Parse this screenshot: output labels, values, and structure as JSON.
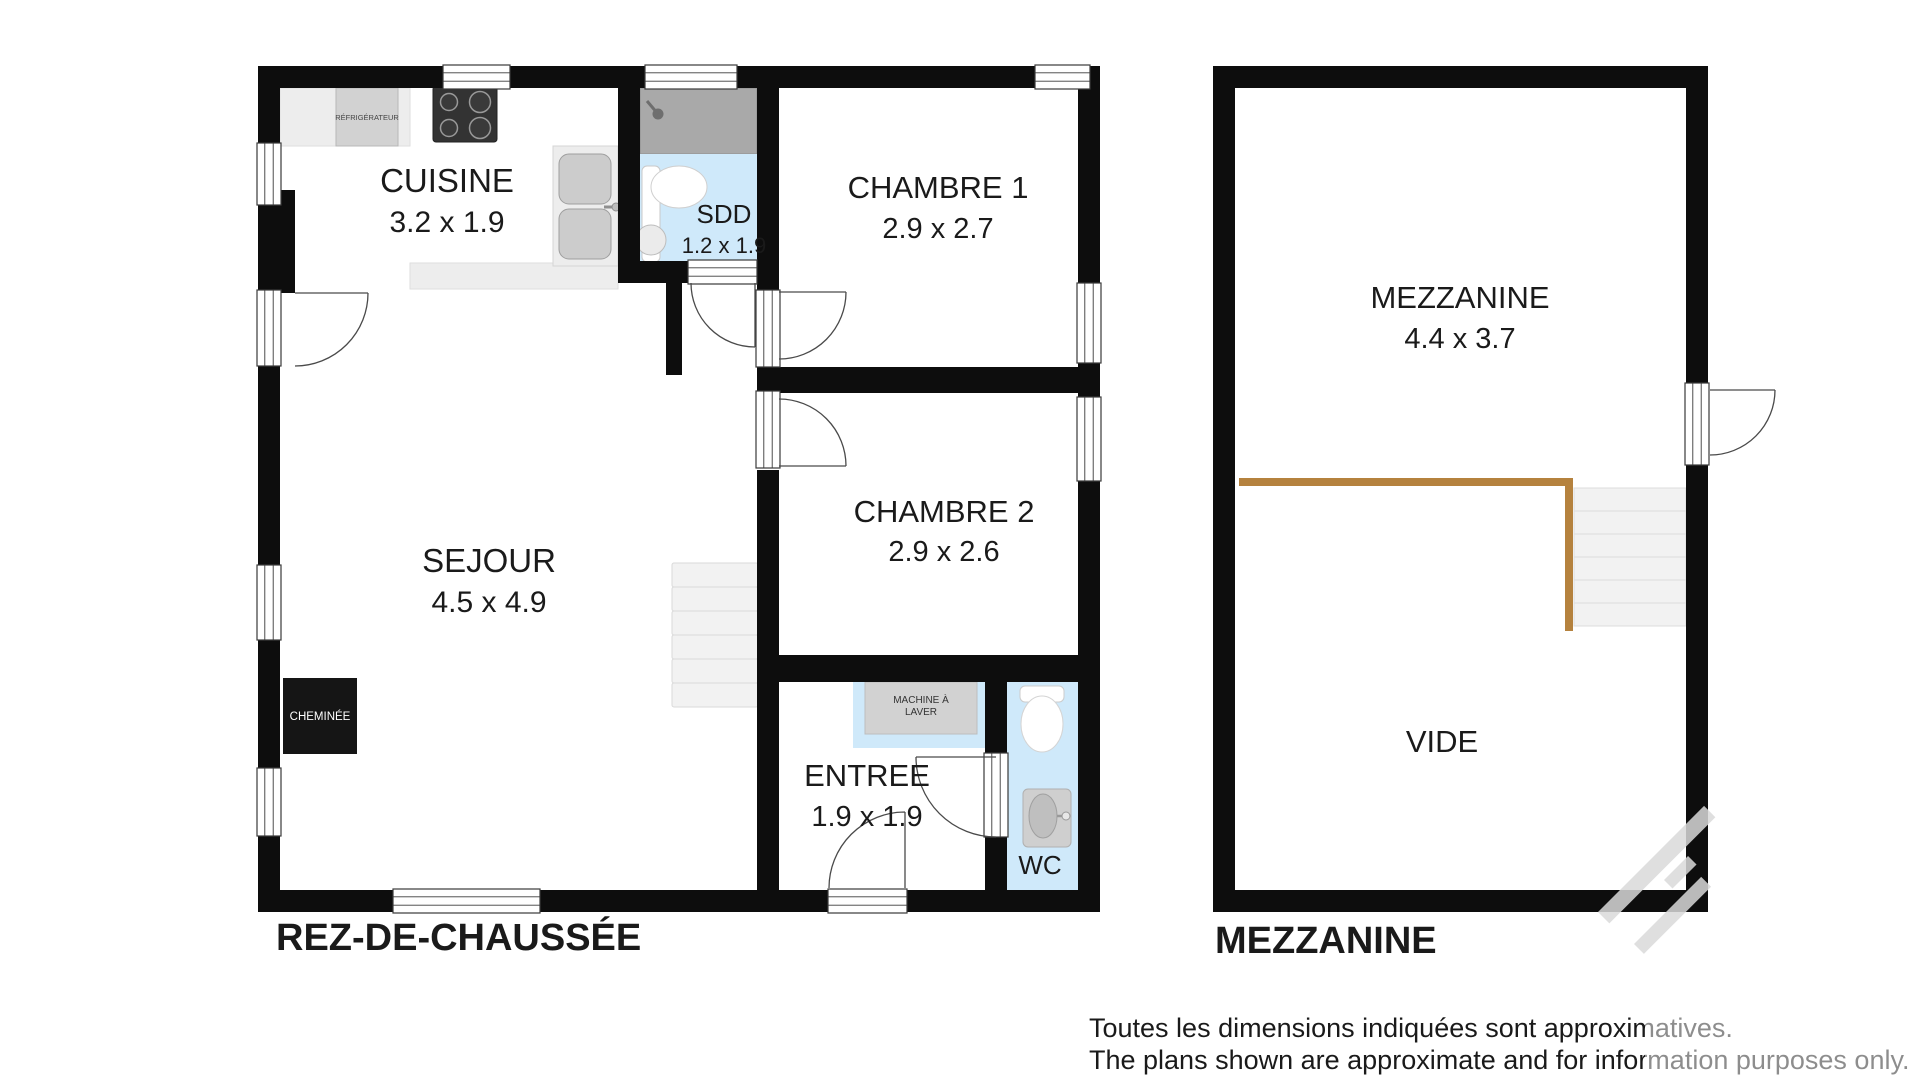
{
  "ground_floor": {
    "title": "REZ-DE-CHAUSSÉE",
    "rooms": [
      {
        "name": "CUISINE",
        "dims": "3.2 x 1.9"
      },
      {
        "name": "SDD",
        "dims": "1.2 x 1.9"
      },
      {
        "name": "CHAMBRE 1",
        "dims": "2.9 x 2.7"
      },
      {
        "name": "CHAMBRE 2",
        "dims": "2.9 x 2.6"
      },
      {
        "name": "SEJOUR",
        "dims": "4.5 x 4.9"
      },
      {
        "name": "ENTREE",
        "dims": "1.9 x 1.9"
      },
      {
        "name": "WC"
      }
    ],
    "appliances": {
      "fridge": "RÉFRIGÉRATEUR",
      "washer_line1": "MACHINE À",
      "washer_line2": "LAVER",
      "fireplace": "CHEMINÉE"
    }
  },
  "mezzanine": {
    "title": "MEZZANINE",
    "rooms": [
      {
        "name": "MEZZANINE",
        "dims": "4.4 x 3.7"
      },
      {
        "name": "VIDE"
      }
    ]
  },
  "disclaimer": {
    "line1": "Toutes les dimensions indiquées sont approximatives.",
    "line2": "The plans shown are approximate and for information purposes only."
  },
  "colors": {
    "wall": "#0d0d0d",
    "water_floor": "#cfe9fa",
    "shower": "#a9a9a9",
    "counter": "#ededed",
    "appliance": "#d2d2d2",
    "stove": "#333333",
    "stairs": "#f2f2f2",
    "railing": "#b5823e",
    "door_line": "#4a4a4a",
    "text": "#1a1a1a",
    "watermark": "#d9d9d9"
  }
}
